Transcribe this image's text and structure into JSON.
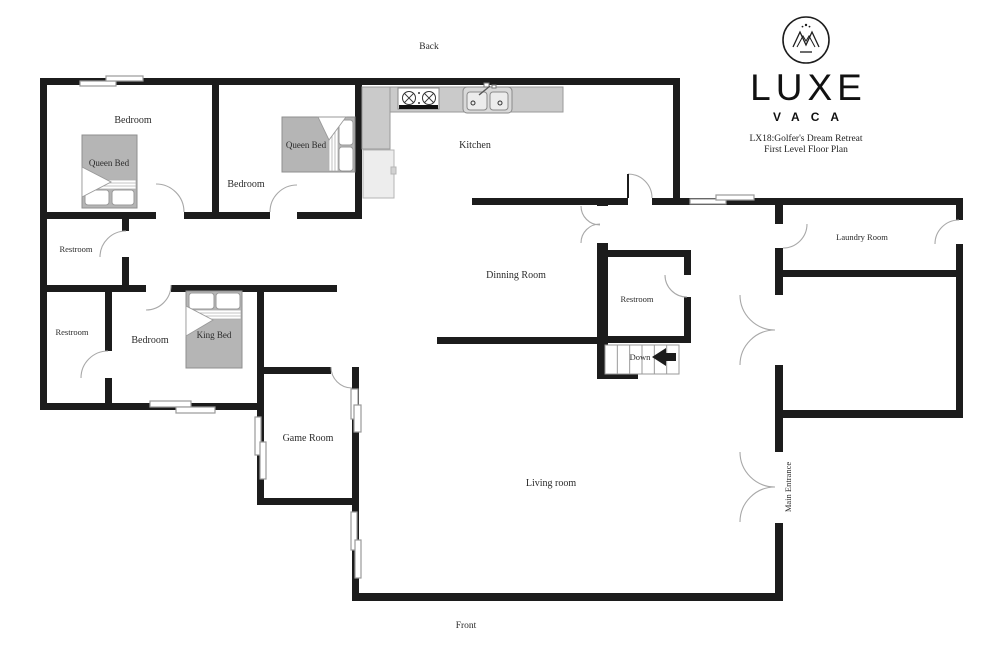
{
  "meta": {
    "width": 1000,
    "height": 649,
    "background": "#ffffff"
  },
  "branding": {
    "name": "LUXE",
    "subname": "VACA",
    "title_line1": "LX18:Golfer's Dream Retreat",
    "title_line2": "First Level Floor Plan",
    "logo_icon": "crown-monogram-in-circle"
  },
  "labels": [
    {
      "id": "back",
      "text": "Back",
      "x": 429,
      "y": 49,
      "s": 9.5
    },
    {
      "id": "front",
      "text": "Front",
      "x": 466,
      "y": 628,
      "s": 9.5
    },
    {
      "id": "bedroom-1",
      "text": "Bedroom",
      "x": 133,
      "y": 123,
      "s": 10
    },
    {
      "id": "queen-bed-1",
      "text": "Queen Bed",
      "x": 109,
      "y": 166,
      "s": 9
    },
    {
      "id": "bedroom-2",
      "text": "Bedroom",
      "x": 246,
      "y": 187,
      "s": 10
    },
    {
      "id": "queen-bed-2",
      "text": "Queen Bed",
      "x": 306,
      "y": 148,
      "s": 9
    },
    {
      "id": "kitchen",
      "text": "Kitchen",
      "x": 475,
      "y": 148,
      "s": 10
    },
    {
      "id": "dining-room",
      "text": "Dinning Room",
      "x": 516,
      "y": 278,
      "s": 10
    },
    {
      "id": "restroom-1",
      "text": "Restroom",
      "x": 76,
      "y": 252,
      "s": 8.5
    },
    {
      "id": "restroom-2",
      "text": "Restroom",
      "x": 72,
      "y": 335,
      "s": 8.5
    },
    {
      "id": "bedroom-3",
      "text": "Bedroom",
      "x": 150,
      "y": 343,
      "s": 10
    },
    {
      "id": "king-bed",
      "text": "King Bed",
      "x": 214,
      "y": 338,
      "s": 9
    },
    {
      "id": "restroom-3",
      "text": "Restroom",
      "x": 637,
      "y": 302,
      "s": 8.5
    },
    {
      "id": "down",
      "text": "Down",
      "x": 640,
      "y": 360,
      "s": 8.5
    },
    {
      "id": "game-room",
      "text": "Game Room",
      "x": 308,
      "y": 441,
      "s": 10
    },
    {
      "id": "living-room",
      "text": "Living room",
      "x": 551,
      "y": 486,
      "s": 10
    },
    {
      "id": "laundry-room",
      "text": "Laundry Room",
      "x": 862,
      "y": 240,
      "s": 8.5
    },
    {
      "id": "main-entrance",
      "text": "Main Entrance",
      "x": 791,
      "y": 487,
      "s": 8.5,
      "rot": -90
    }
  ],
  "floorplan": {
    "colors": {
      "wall": "#1c1c1c",
      "door": "#a8a8a8",
      "window_stroke": "#9a9a9a",
      "bed": "#b5b5b5",
      "bed_stroke": "#8f8f8f",
      "pillow_stroke": "#9a9a9a",
      "stair_stroke": "#9a9a9a",
      "label": "#2b2b2b"
    },
    "walls": [
      [
        40,
        78,
        640,
        7
      ],
      [
        40,
        78,
        7,
        332
      ],
      [
        673,
        78,
        7,
        127
      ],
      [
        212,
        78,
        7,
        141
      ],
      [
        355,
        78,
        7,
        141
      ],
      [
        40,
        212,
        116,
        7
      ],
      [
        184,
        212,
        86,
        7
      ],
      [
        297,
        212,
        65,
        7
      ],
      [
        122,
        212,
        7,
        19
      ],
      [
        122,
        257,
        7,
        35
      ],
      [
        40,
        285,
        106,
        7
      ],
      [
        171,
        285,
        166,
        7
      ],
      [
        105,
        292,
        7,
        59
      ],
      [
        105,
        378,
        7,
        32
      ],
      [
        40,
        403,
        224,
        7
      ],
      [
        257,
        285,
        7,
        220
      ],
      [
        257,
        498,
        96,
        7
      ],
      [
        257,
        367,
        74,
        7
      ],
      [
        352,
        367,
        7,
        231
      ],
      [
        352,
        593,
        431,
        8
      ],
      [
        775,
        410,
        8,
        42
      ],
      [
        775,
        523,
        8,
        78
      ],
      [
        775,
        198,
        8,
        26
      ],
      [
        775,
        248,
        8,
        47
      ],
      [
        775,
        365,
        8,
        47
      ],
      [
        472,
        198,
        156,
        7
      ],
      [
        652,
        198,
        123,
        7
      ],
      [
        775,
        198,
        188,
        7
      ],
      [
        956,
        198,
        7,
        22
      ],
      [
        956,
        244,
        7,
        174
      ],
      [
        775,
        270,
        188,
        7
      ],
      [
        775,
        410,
        188,
        8
      ],
      [
        437,
        337,
        167,
        7
      ],
      [
        597,
        198,
        11,
        8
      ],
      [
        597,
        243,
        11,
        136
      ],
      [
        597,
        372,
        41,
        7
      ],
      [
        603,
        250,
        88,
        7
      ],
      [
        684,
        250,
        7,
        25
      ],
      [
        684,
        297,
        7,
        46
      ],
      [
        603,
        336,
        88,
        7
      ]
    ],
    "windows": [
      [
        80,
        81,
        36,
        5
      ],
      [
        106,
        76,
        37,
        5
      ],
      [
        690,
        199,
        36,
        5
      ],
      [
        716,
        195,
        38,
        5
      ],
      [
        150,
        401,
        41,
        6
      ],
      [
        176,
        407,
        39,
        6
      ],
      [
        255,
        417,
        6,
        38
      ],
      [
        260,
        442,
        6,
        37
      ],
      [
        351,
        389,
        7,
        30
      ],
      [
        354,
        405,
        7,
        27
      ],
      [
        351,
        512,
        6,
        38
      ],
      [
        355,
        540,
        6,
        38
      ]
    ],
    "doors": [
      "M 184 212 A 28 28 0 0 0 156 184",
      "M 270 212 A 27 27 0 0 1 297 185",
      "M 126 231 A 26 26 0 0 0 100 257",
      "M 171 285 A 25 25 0 0 1 146 310",
      "M 108 351 A 27 27 0 0 0 81 378",
      "M 331 367 A 21 21 0 0 0 352 388",
      "M 628 174 A 24 24 0 0 1 652 198",
      "M 600 225 A 19 19 0 0 1 581 206",
      "M 600 224 A 19 19 0 0 0 581 243",
      "M 665 275 A 22 22 0 0 0 687 297",
      "M 807 224 A 24 24 0 0 1 783 248",
      "M 935 244 A 24 24 0 0 1 959 220",
      "M 740 295 A 35 35 0 0 0 775 330",
      "M 775 330 A 35 35 0 0 0 740 365",
      "M 740 452 A 35 35 0 0 0 775 487",
      "M 775 487 A 35 35 0 0 0 740 522"
    ],
    "door_leaves": [
      [
        628,
        174,
        628,
        198
      ]
    ],
    "fixtures": [
      {
        "name": "kitchen-counter",
        "r": [
          362,
          87,
          201,
          25
        ],
        "fill": "#cacaca",
        "stroke": "#9a9a9a"
      },
      {
        "name": "kitchen-counter-column",
        "r": [
          362,
          87,
          28,
          62
        ],
        "fill": "#cacaca",
        "stroke": "#9a9a9a"
      },
      {
        "name": "fridge",
        "r": [
          363,
          150,
          31,
          48
        ],
        "fill": "#ededed",
        "stroke": "#b5b5b5"
      },
      {
        "name": "fridge-handle",
        "r": [
          391,
          167,
          5,
          7
        ],
        "fill": "#d2d2d2",
        "stroke": "#b5b5b5"
      },
      {
        "name": "stove",
        "r": [
          398,
          88,
          41,
          21
        ],
        "fill": "#ffffff",
        "stroke": "#8a8a8a"
      },
      {
        "name": "stove-bar",
        "r": [
          399,
          105,
          39,
          4
        ],
        "fill": "#111111",
        "stroke": "none"
      },
      {
        "name": "sink",
        "r": [
          463,
          87,
          49,
          26
        ],
        "rx": 4,
        "fill": "#d9d9d9",
        "stroke": "#8a8a8a"
      },
      {
        "name": "sink-basin-left",
        "r": [
          467,
          92,
          20,
          18
        ],
        "rx": 3,
        "fill": "#ececec",
        "stroke": "#8a8a8a"
      },
      {
        "name": "sink-basin-right",
        "r": [
          490,
          92,
          18,
          18
        ],
        "rx": 3,
        "fill": "#ececec",
        "stroke": "#8a8a8a"
      },
      {
        "name": "faucet-knob-a",
        "r": [
          484,
          83,
          5,
          4
        ],
        "fill": "#ffffff",
        "stroke": "#777777"
      },
      {
        "name": "faucet-knob-b",
        "r": [
          492,
          85,
          4,
          3
        ],
        "fill": "#ffffff",
        "stroke": "#777777"
      }
    ],
    "circles": [
      {
        "name": "stove-burner",
        "c": [
          409,
          98,
          6.5
        ],
        "cross": true
      },
      {
        "name": "stove-burner",
        "c": [
          429,
          98,
          6.5
        ],
        "cross": true
      },
      {
        "name": "stove-dot",
        "c": [
          419,
          93,
          1
        ],
        "fill": "#333333"
      },
      {
        "name": "stove-dot",
        "c": [
          419,
          103,
          1
        ],
        "fill": "#333333"
      },
      {
        "name": "sink-drain",
        "c": [
          473,
          103,
          2
        ]
      },
      {
        "name": "sink-drain",
        "c": [
          500,
          103,
          2
        ]
      }
    ],
    "lines": [
      {
        "name": "faucet-spout",
        "p": [
          479,
          95,
          490,
          86
        ]
      }
    ],
    "beds": [
      {
        "name": "queen-bed-1",
        "frame": [
          82,
          135,
          55,
          73
        ],
        "band": [
          83,
          180,
          53,
          9
        ],
        "dir": "h",
        "pillows": [
          [
            85,
            190,
            24,
            15
          ],
          [
            112,
            190,
            22,
            15
          ]
        ],
        "fold": "82,167 82,197 111,182"
      },
      {
        "name": "queen-bed-2",
        "frame": [
          282,
          117,
          73,
          55
        ],
        "band": [
          329,
          118,
          9,
          53
        ],
        "dir": "v",
        "pillows": [
          [
            339,
            120,
            14,
            25
          ],
          [
            339,
            147,
            14,
            24
          ]
        ],
        "fold": "318,117 346,117 329,140"
      },
      {
        "name": "king-bed",
        "frame": [
          186,
          291,
          56,
          77
        ],
        "band": [
          187,
          310,
          54,
          9
        ],
        "dir": "h",
        "pillows": [
          [
            189,
            293,
            25,
            16
          ],
          [
            216,
            293,
            24,
            16
          ]
        ],
        "fold": "186,306 186,336 213,320"
      }
    ],
    "stairs": {
      "box": [
        605,
        345,
        74,
        29
      ],
      "steps": 6,
      "arrow": "652,357 666,348 666,353 676,353 676,361 666,361 666,366"
    }
  }
}
